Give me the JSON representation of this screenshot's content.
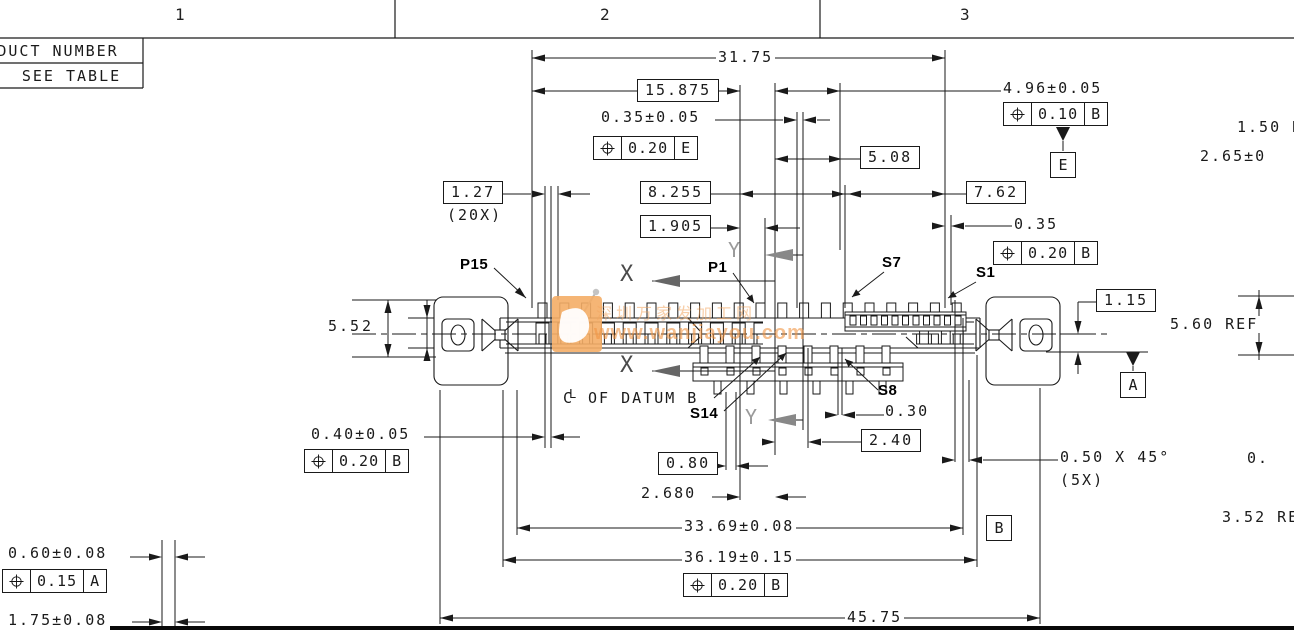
{
  "zones": {
    "z1": "1",
    "z2": "2",
    "z3": "3"
  },
  "title_block": {
    "product_number": "PRODUCT NUMBER",
    "see_table": "SEE TABLE"
  },
  "watermark": {
    "cn": "深圳万家发加工网",
    "url": "www.wanjiayou.com",
    "logo_color": "#f4ad66"
  },
  "labels": {
    "p15": "P15",
    "p1": "P1",
    "s7": "S7",
    "s1": "S1",
    "s14": "S14",
    "s8": "S8",
    "x": "X",
    "y": "Y",
    "cl_c": "C",
    "cl_l": "L",
    "datum_note": "OF DATUM B"
  },
  "datum_flags": {
    "a": "A",
    "b": "B",
    "e": "E"
  },
  "dims": {
    "v31_75": "31.75",
    "v15_875": "15.875",
    "v035t": "0.35±0.05",
    "v496": "4.96±0.05",
    "v508": "5.08",
    "v127": "1.27",
    "v127n": "(20X)",
    "v8255": "8.255",
    "v762": "7.62",
    "v1905": "1.905",
    "v035r": "0.35",
    "v115": "1.15",
    "v55": "5.5",
    "v2": "2",
    "v560": "5.60 REF",
    "v150": "1.50 R",
    "v265": "2.65±0",
    "v040": "0.40±0.05",
    "v030": "0.30",
    "v240": "2.40",
    "v080": "0.80",
    "v2680": "2.680",
    "v050": "0.50 X 45°",
    "v050n": "(5X)",
    "v3369": "33.69±0.08",
    "v3619": "36.19±0.15",
    "v4575": "45.75",
    "v060": "0.60±0.08",
    "v175": "1.75±0.08",
    "v352": "3.52 REF",
    "v0cut": "0."
  },
  "fcf": {
    "e_020": {
      "tol": "0.20",
      "datum": "E"
    },
    "b_010": {
      "tol": "0.10",
      "datum": "B"
    },
    "b_020_right": {
      "tol": "0.20",
      "datum": "B"
    },
    "b_020_left": {
      "tol": "0.20",
      "datum": "B"
    },
    "b_020_bottom": {
      "tol": "0.20",
      "datum": "B"
    },
    "a_015": {
      "tol": "0.15",
      "datum": "A"
    }
  }
}
